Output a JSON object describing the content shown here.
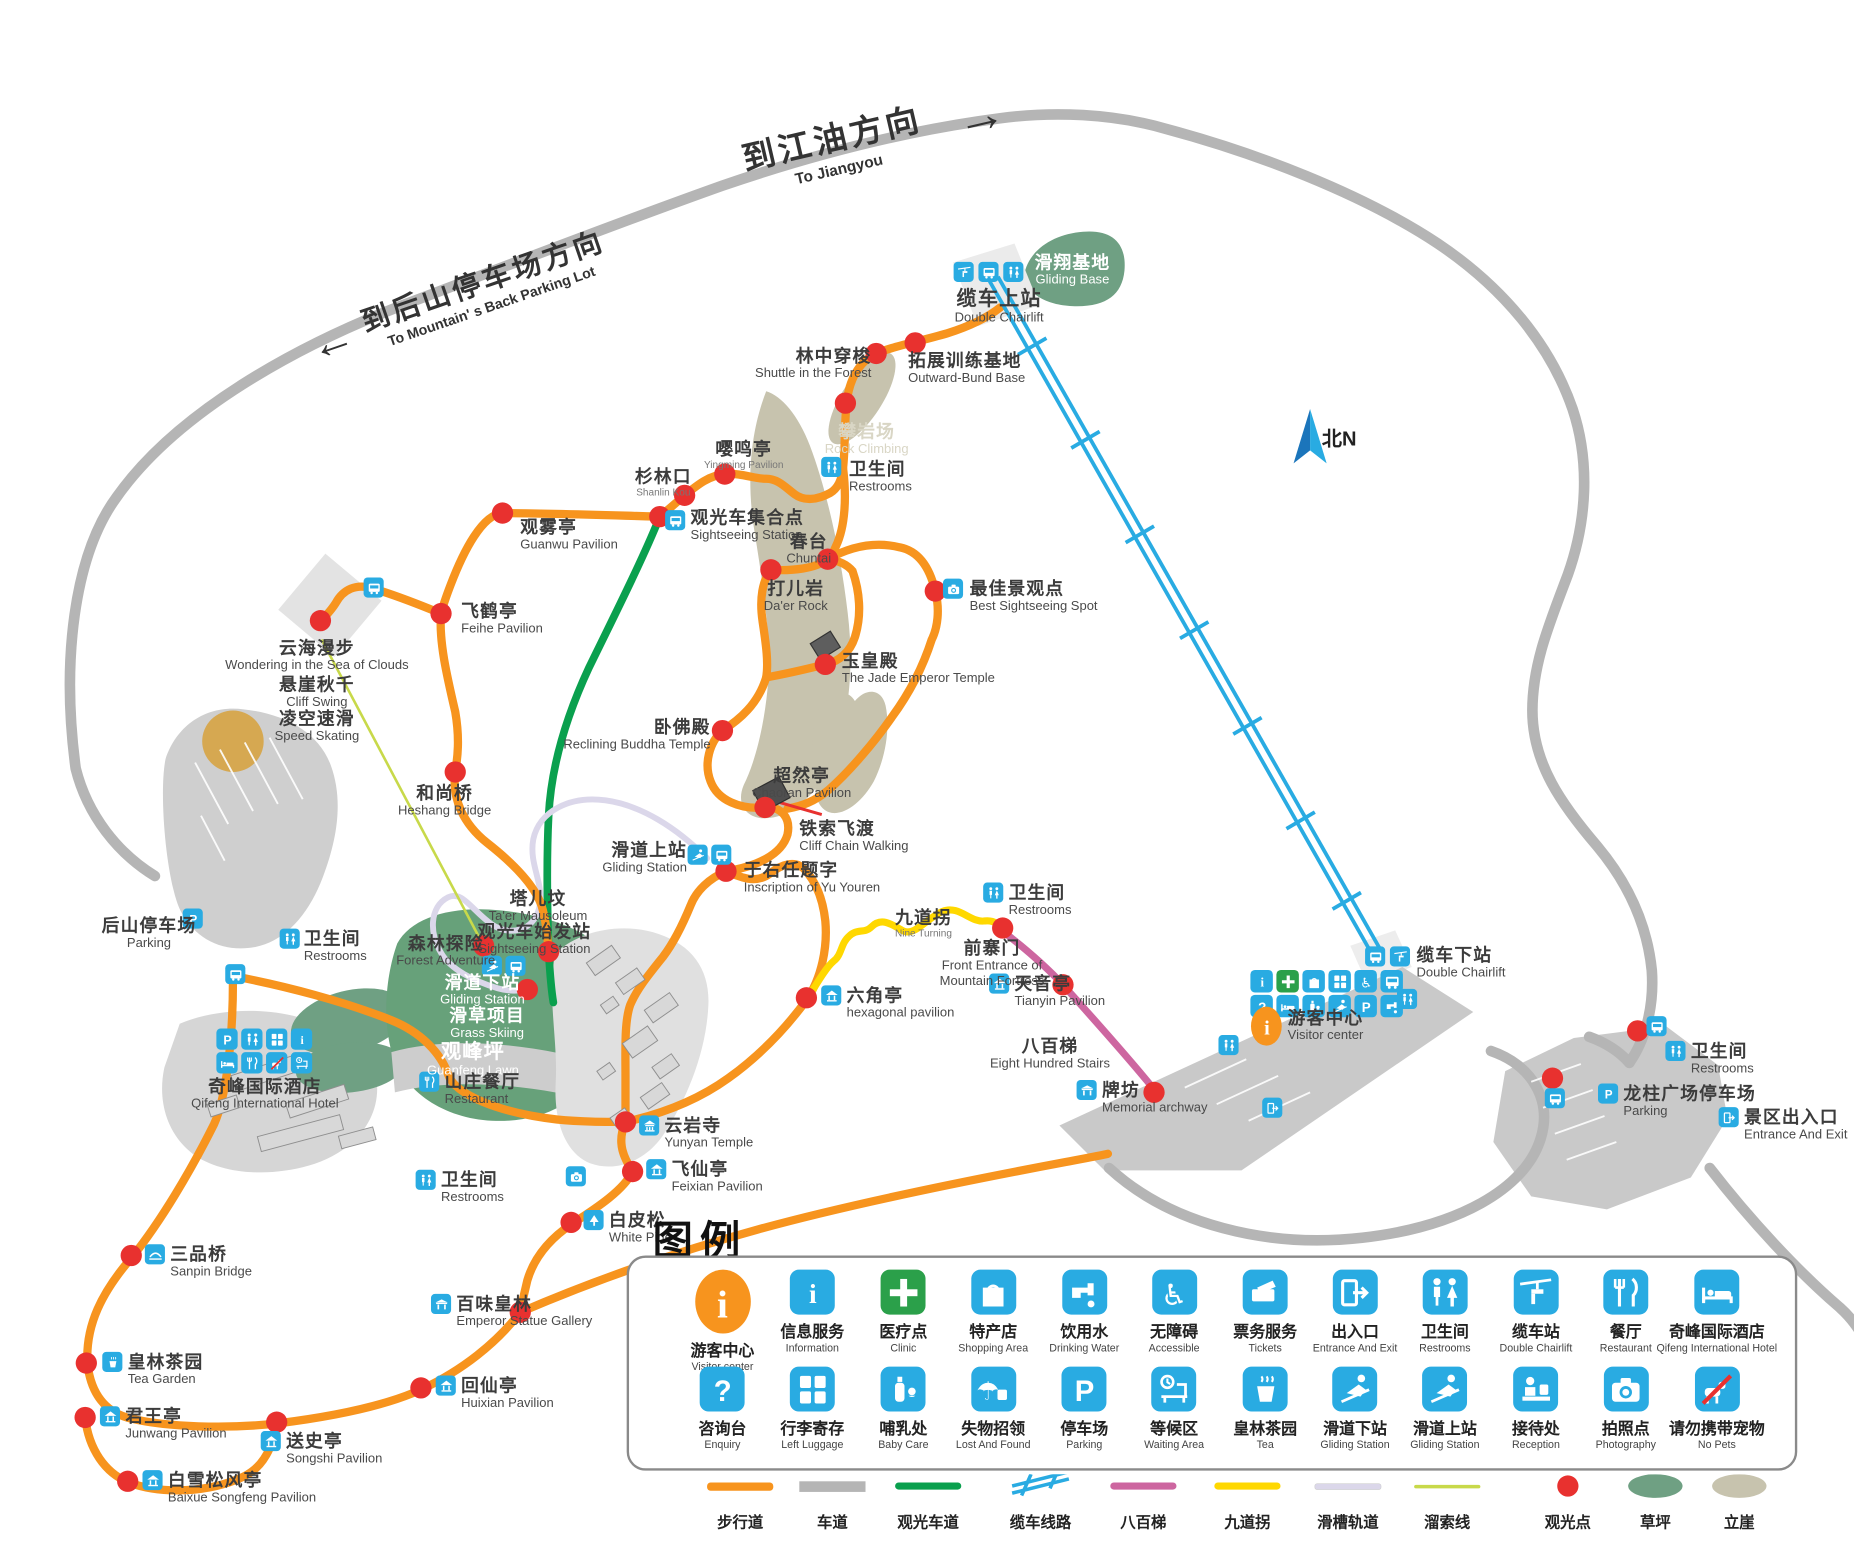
{
  "directions": {
    "jiangyou": {
      "cn": "到江油方向",
      "en": "To Jiangyou",
      "arrow": "→"
    },
    "back_parking": {
      "cn": "到后山停车场方向",
      "en": "To Mountain' s Back Parking Lot",
      "arrow": "←"
    }
  },
  "compass": {
    "label": "北N"
  },
  "colors": {
    "walking": "#F7941E",
    "road": "#B5B5B5",
    "sightseeing": "#0AA04E",
    "cable": "#29ABE2",
    "stairs": "#CD66A0",
    "nineturn": "#FFD800",
    "chute": "#DBD7EA",
    "zipline": "#C8D94A",
    "spot": "#E8312F",
    "lawn": "#6FA083",
    "cliff": "#C7C3AE",
    "chip": "#29ABE2",
    "visitor": "#F7941E",
    "clinic": "#2BA04A"
  },
  "pois": [
    {
      "id": "gliding-base",
      "cn": "滑翔基地",
      "en": "Gliding Base",
      "x": 907,
      "y": 214,
      "a": "c",
      "cls": "white"
    },
    {
      "id": "cable-top-station",
      "cn": "缆车上站",
      "en": "Double Chairlift",
      "x": 845,
      "y": 243,
      "a": "c",
      "cls": "bigcn"
    },
    {
      "id": "outward-bund-base",
      "cn": "拓展训练基地",
      "en": "Outward-Bund Base",
      "x": 768,
      "y": 297,
      "a": "l"
    },
    {
      "id": "shuttle-in-forest",
      "cn": "林中穿梭",
      "en": "Shuttle in the Forest",
      "x": 737,
      "y": 293,
      "a": "r"
    },
    {
      "id": "rock-climbing",
      "cn": "攀岩场",
      "en": "Rock Climbing",
      "x": 733,
      "y": 357,
      "a": "c",
      "cls": "pale"
    },
    {
      "id": "restrooms-north",
      "cn": "卫生间",
      "en": "Restrooms",
      "x": 718,
      "y": 389,
      "a": "l"
    },
    {
      "id": "yingming-pavilion",
      "cn": "嘤鸣亭",
      "en": "Yingming Pavilion",
      "x": 629,
      "y": 372,
      "a": "c",
      "cls": "smen"
    },
    {
      "id": "shanlinkou",
      "cn": "杉林口",
      "en": "Shanlin Kou",
      "x": 561,
      "y": 395,
      "a": "c",
      "cls": "smen"
    },
    {
      "id": "sightseeing-meet",
      "cn": "观光车集合点",
      "en": "Sightseeing Station",
      "x": 584,
      "y": 430,
      "a": "l"
    },
    {
      "id": "guanwu-pavilion",
      "cn": "观雾亭",
      "en": "Guanwu Pavilion",
      "x": 440,
      "y": 438,
      "a": "l"
    },
    {
      "id": "chuntai",
      "cn": "春台",
      "en": "Chuntai",
      "x": 684,
      "y": 450,
      "a": "c"
    },
    {
      "id": "daer-rock",
      "cn": "打儿岩",
      "en": "Da'er Rock",
      "x": 673,
      "y": 490,
      "a": "c"
    },
    {
      "id": "best-sightseeing",
      "cn": "最佳景观点",
      "en": "Best Sightseeing Spot",
      "x": 820,
      "y": 490,
      "a": "l"
    },
    {
      "id": "feihe-pavilion",
      "cn": "飞鹤亭",
      "en": "Feihe Pavilion",
      "x": 390,
      "y": 509,
      "a": "l"
    },
    {
      "id": "sea-of-clouds",
      "cn": "云海漫步",
      "en": "Wondering in the Sea of Clouds",
      "x": 268,
      "y": 540,
      "a": "c"
    },
    {
      "id": "cliff-swing",
      "cn": "悬崖秋千",
      "en": "Cliff Swing",
      "x": 268,
      "y": 571,
      "a": "c"
    },
    {
      "id": "speed-skating",
      "cn": "凌空速滑",
      "en": "Speed Skating",
      "x": 268,
      "y": 600,
      "a": "c"
    },
    {
      "id": "jade-emperor-temple",
      "cn": "玉皇殿",
      "en": "The Jade Emperor Temple",
      "x": 712,
      "y": 551,
      "a": "l"
    },
    {
      "id": "reclining-buddha-temple",
      "cn": "卧佛殿",
      "en": "Reclining Buddha Temple",
      "x": 601,
      "y": 607,
      "a": "r"
    },
    {
      "id": "chaoran-pavilion",
      "cn": "超然亭",
      "en": "Chaoran Pavilion",
      "x": 678,
      "y": 648,
      "a": "c"
    },
    {
      "id": "cliff-chain-walking",
      "cn": "铁索飞渡",
      "en": "Cliff Chain Walking",
      "x": 676,
      "y": 693,
      "a": "l"
    },
    {
      "id": "heshang-bridge",
      "cn": "和尚桥",
      "en": "Heshang Bridge",
      "x": 376,
      "y": 663,
      "a": "c"
    },
    {
      "id": "gliding-station-top",
      "cn": "滑道上站",
      "en": "Gliding Station",
      "x": 581,
      "y": 711,
      "a": "r"
    },
    {
      "id": "yu-youren-inscription",
      "cn": "于右任题字",
      "en": "Inscription of Yu Youren",
      "x": 629,
      "y": 728,
      "a": "l"
    },
    {
      "id": "taer-mausoleum",
      "cn": "塔儿坟",
      "en": "Ta'er Mausoleum",
      "x": 455,
      "y": 752,
      "a": "c"
    },
    {
      "id": "sightseeing-start",
      "cn": "观光车始发站",
      "en": "Sightseeing Station",
      "x": 452,
      "y": 780,
      "a": "c"
    },
    {
      "id": "forest-adventure",
      "cn": "森林探险",
      "en": "Forest Adventure",
      "x": 377,
      "y": 790,
      "a": "c"
    },
    {
      "id": "gliding-station-lower",
      "cn": "滑道下站",
      "en": "Gliding Station",
      "x": 408,
      "y": 823,
      "a": "c",
      "cls": "white"
    },
    {
      "id": "grass-skiing",
      "cn": "滑草项目",
      "en": "Grass Skiing",
      "x": 412,
      "y": 851,
      "a": "c",
      "cls": "white"
    },
    {
      "id": "guanfeng-lawn",
      "cn": "观峰坪",
      "en": "Guanfeng Lawn",
      "x": 400,
      "y": 880,
      "a": "c",
      "cls": "white bigcn"
    },
    {
      "id": "restaurant",
      "cn": "山庄餐厅",
      "en": "Restaurant",
      "x": 376,
      "y": 907,
      "a": "l"
    },
    {
      "id": "nine-turning",
      "cn": "九道拐",
      "en": "Nine Turning",
      "x": 781,
      "y": 768,
      "a": "c",
      "cls": "smen"
    },
    {
      "id": "restrooms-nineturn",
      "cn": "卫生间",
      "en": "Restrooms",
      "x": 853,
      "y": 747,
      "a": "l"
    },
    {
      "id": "front-entrance-fortress",
      "cn": "前寨门",
      "en": "Front Entrance of\nMountain Fortress",
      "x": 839,
      "y": 794,
      "a": "c"
    },
    {
      "id": "tianyin-pavilion",
      "cn": "天音亭",
      "en": "Tianyin Pavilion",
      "x": 858,
      "y": 824,
      "a": "l"
    },
    {
      "id": "eight-hundred-stairs",
      "cn": "八百梯",
      "en": "Eight Hundred Stairs",
      "x": 888,
      "y": 877,
      "a": "c"
    },
    {
      "id": "memorial-archway",
      "cn": "牌坊",
      "en": "Memorial archway",
      "x": 932,
      "y": 914,
      "a": "l"
    },
    {
      "id": "visitor-center",
      "cn": "游客中心",
      "en": "Visitor center",
      "x": 1089,
      "y": 853,
      "a": "l"
    },
    {
      "id": "cable-bottom-station",
      "cn": "缆车下站",
      "en": "Double Chairlift",
      "x": 1198,
      "y": 800,
      "a": "l"
    },
    {
      "id": "restrooms-east-lot",
      "cn": "卫生间",
      "en": "Restrooms",
      "x": 1430,
      "y": 881,
      "a": "l"
    },
    {
      "id": "longzhu-square-parking",
      "cn": "龙柱广场停车场",
      "en": "Parking",
      "x": 1373,
      "y": 917,
      "a": "l"
    },
    {
      "id": "scenic-entrance-exit",
      "cn": "景区出入口",
      "en": "Entrance And Exit",
      "x": 1475,
      "y": 937,
      "a": "l"
    },
    {
      "id": "back-mountain-parking",
      "cn": "后山停车场",
      "en": "Parking",
      "x": 126,
      "y": 775,
      "a": "c"
    },
    {
      "id": "restrooms-back-lot",
      "cn": "卫生间",
      "en": "Restrooms",
      "x": 257,
      "y": 786,
      "a": "l"
    },
    {
      "id": "qifeng-hotel",
      "cn": "奇峰国际酒店",
      "en": "Qifeng International Hotel",
      "x": 224,
      "y": 911,
      "a": "c"
    },
    {
      "id": "restrooms-temple",
      "cn": "卫生间",
      "en": "Restrooms",
      "x": 373,
      "y": 990,
      "a": "l"
    },
    {
      "id": "yunyan-temple",
      "cn": "云岩寺",
      "en": "Yunyan Temple",
      "x": 562,
      "y": 944,
      "a": "l"
    },
    {
      "id": "feixian-pavilion",
      "cn": "飞仙亭",
      "en": "Feixian Pavilion",
      "x": 568,
      "y": 981,
      "a": "l"
    },
    {
      "id": "white-pine",
      "cn": "白皮松",
      "en": "White Pine",
      "x": 515,
      "y": 1024,
      "a": "l"
    },
    {
      "id": "emperor-statue-gallery",
      "cn": "百味皇林",
      "en": "Emperor Statue Gallery",
      "x": 386,
      "y": 1095,
      "a": "l"
    },
    {
      "id": "sanpin-bridge",
      "cn": "三品桥",
      "en": "Sanpin Bridge",
      "x": 144,
      "y": 1053,
      "a": "l"
    },
    {
      "id": "tea-garden",
      "cn": "皇林茶园",
      "en": "Tea Garden",
      "x": 108,
      "y": 1144,
      "a": "l"
    },
    {
      "id": "junwang-pavilion",
      "cn": "君王亭",
      "en": "Junwang Pavilion",
      "x": 106,
      "y": 1190,
      "a": "l"
    },
    {
      "id": "songshi-pavilion",
      "cn": "送史亭",
      "en": "Songshi Pavilion",
      "x": 242,
      "y": 1211,
      "a": "l"
    },
    {
      "id": "huixian-pavilion",
      "cn": "回仙亭",
      "en": "Huixian Pavilion",
      "x": 390,
      "y": 1164,
      "a": "l"
    },
    {
      "id": "baixue-songfeng-pavilion",
      "cn": "白雪松风亭",
      "en": "Baixue Songfeng Pavilion",
      "x": 142,
      "y": 1244,
      "a": "l"
    },
    {
      "id": "hexagonal-pavilion",
      "cn": "六角亭",
      "en": "hexagonal pavilion",
      "x": 716,
      "y": 834,
      "a": "l"
    }
  ],
  "chips": [
    {
      "icon": "chairlift",
      "x": 815,
      "y": 230
    },
    {
      "icon": "bus",
      "x": 836,
      "y": 230
    },
    {
      "icon": "restrooms",
      "x": 857,
      "y": 230
    },
    {
      "icon": "restrooms",
      "x": 703,
      "y": 395
    },
    {
      "icon": "bus",
      "x": 571,
      "y": 440
    },
    {
      "icon": "bus",
      "x": 316,
      "y": 497
    },
    {
      "icon": "camera",
      "x": 806,
      "y": 498
    },
    {
      "icon": "gliding",
      "x": 590,
      "y": 723
    },
    {
      "icon": "bus",
      "x": 610,
      "y": 723
    },
    {
      "icon": "gliding",
      "x": 416,
      "y": 817
    },
    {
      "icon": "bus",
      "x": 436,
      "y": 817
    },
    {
      "icon": "restaurant",
      "x": 363,
      "y": 915
    },
    {
      "icon": "restrooms",
      "x": 360,
      "y": 998
    },
    {
      "icon": "temple",
      "x": 549,
      "y": 952
    },
    {
      "icon": "camera",
      "x": 487,
      "y": 995
    },
    {
      "icon": "pavilion",
      "x": 555,
      "y": 989
    },
    {
      "icon": "pine",
      "x": 502,
      "y": 1032
    },
    {
      "icon": "archway",
      "x": 373,
      "y": 1103
    },
    {
      "icon": "bridge",
      "x": 131,
      "y": 1061
    },
    {
      "icon": "tea",
      "x": 95,
      "y": 1152
    },
    {
      "icon": "pavilion",
      "x": 93,
      "y": 1198
    },
    {
      "icon": "pavilion",
      "x": 229,
      "y": 1219
    },
    {
      "icon": "pavilion",
      "x": 377,
      "y": 1172
    },
    {
      "icon": "pavilion",
      "x": 129,
      "y": 1252
    },
    {
      "icon": "pavilion",
      "x": 703,
      "y": 842
    },
    {
      "icon": "restrooms",
      "x": 840,
      "y": 755
    },
    {
      "icon": "pavilion",
      "x": 845,
      "y": 832
    },
    {
      "icon": "archway",
      "x": 919,
      "y": 922
    },
    {
      "icon": "bus",
      "x": 1163,
      "y": 809
    },
    {
      "icon": "chairlift",
      "x": 1184,
      "y": 809
    },
    {
      "icon": "restrooms",
      "x": 1190,
      "y": 845
    },
    {
      "icon": "restrooms",
      "x": 1039,
      "y": 884
    },
    {
      "icon": "exit",
      "x": 1076,
      "y": 937
    },
    {
      "icon": "restrooms",
      "x": 1417,
      "y": 889
    },
    {
      "icon": "parking",
      "x": 1360,
      "y": 925
    },
    {
      "icon": "exit",
      "x": 1462,
      "y": 945
    },
    {
      "icon": "parking",
      "x": 163,
      "y": 777
    },
    {
      "icon": "restrooms",
      "x": 245,
      "y": 794
    },
    {
      "icon": "bus",
      "x": 199,
      "y": 824
    },
    {
      "icon": "bus",
      "x": 1401,
      "y": 868
    },
    {
      "icon": "bus",
      "x": 1315,
      "y": 929
    },
    {
      "icon": "information",
      "x": 1067,
      "y": 830,
      "s": 19
    },
    {
      "icon": "clinic",
      "x": 1089,
      "y": 830,
      "s": 19
    },
    {
      "icon": "shopping",
      "x": 1111,
      "y": 830,
      "s": 19
    },
    {
      "icon": "luggage",
      "x": 1133,
      "y": 830,
      "s": 19
    },
    {
      "icon": "accessible",
      "x": 1155,
      "y": 830,
      "s": 19
    },
    {
      "icon": "bus",
      "x": 1177,
      "y": 830,
      "s": 19
    },
    {
      "icon": "question",
      "x": 1067,
      "y": 851,
      "s": 19
    },
    {
      "icon": "hotel",
      "x": 1089,
      "y": 851,
      "s": 19
    },
    {
      "icon": "baby",
      "x": 1111,
      "y": 851,
      "s": 19
    },
    {
      "icon": "gliding",
      "x": 1133,
      "y": 851,
      "s": 19
    },
    {
      "icon": "parking",
      "x": 1155,
      "y": 851,
      "s": 19
    },
    {
      "icon": "water",
      "x": 1177,
      "y": 851,
      "s": 19
    },
    {
      "icon": "visitor",
      "x": 1071,
      "y": 868
    },
    {
      "icon": "parking",
      "x": 192,
      "y": 879,
      "s": 18
    },
    {
      "icon": "restrooms",
      "x": 213,
      "y": 879,
      "s": 18
    },
    {
      "icon": "luggage",
      "x": 234,
      "y": 879,
      "s": 18
    },
    {
      "icon": "information",
      "x": 255,
      "y": 879,
      "s": 18
    },
    {
      "icon": "hotel",
      "x": 192,
      "y": 899,
      "s": 18
    },
    {
      "icon": "restaurant",
      "x": 213,
      "y": 899,
      "s": 18
    },
    {
      "icon": "nopets",
      "x": 234,
      "y": 899,
      "s": 18
    },
    {
      "icon": "waiting",
      "x": 255,
      "y": 899,
      "s": 18
    }
  ],
  "dots": [
    {
      "x": 741,
      "y": 299
    },
    {
      "x": 774,
      "y": 290
    },
    {
      "x": 715,
      "y": 341
    },
    {
      "x": 613,
      "y": 401
    },
    {
      "x": 579,
      "y": 419
    },
    {
      "x": 558,
      "y": 437
    },
    {
      "x": 425,
      "y": 434
    },
    {
      "x": 373,
      "y": 519
    },
    {
      "x": 271,
      "y": 525
    },
    {
      "x": 700,
      "y": 473
    },
    {
      "x": 652,
      "y": 482
    },
    {
      "x": 791,
      "y": 500
    },
    {
      "x": 698,
      "y": 562
    },
    {
      "x": 611,
      "y": 618
    },
    {
      "x": 647,
      "y": 683
    },
    {
      "x": 614,
      "y": 737
    },
    {
      "x": 385,
      "y": 653
    },
    {
      "x": 464,
      "y": 805
    },
    {
      "x": 409,
      "y": 800
    },
    {
      "x": 446,
      "y": 837
    },
    {
      "x": 529,
      "y": 949
    },
    {
      "x": 535,
      "y": 991
    },
    {
      "x": 483,
      "y": 1034
    },
    {
      "x": 440,
      "y": 1110
    },
    {
      "x": 111,
      "y": 1062
    },
    {
      "x": 73,
      "y": 1153
    },
    {
      "x": 72,
      "y": 1199
    },
    {
      "x": 234,
      "y": 1203
    },
    {
      "x": 356,
      "y": 1174
    },
    {
      "x": 108,
      "y": 1253
    },
    {
      "x": 682,
      "y": 844
    },
    {
      "x": 848,
      "y": 785
    },
    {
      "x": 899,
      "y": 833
    },
    {
      "x": 976,
      "y": 924
    },
    {
      "x": 1385,
      "y": 872
    },
    {
      "x": 1313,
      "y": 912
    }
  ],
  "legend": {
    "title": "图例",
    "row1": [
      {
        "icon": "visitor",
        "cn": "游客中心",
        "en": "Visitor center"
      },
      {
        "icon": "information",
        "cn": "信息服务",
        "en": "Information"
      },
      {
        "icon": "clinic",
        "cn": "医疗点",
        "en": "Clinic"
      },
      {
        "icon": "shopping",
        "cn": "特产店",
        "en": "Shopping Area"
      },
      {
        "icon": "water",
        "cn": "饮用水",
        "en": "Drinking Water"
      },
      {
        "icon": "accessible",
        "cn": "无障碍",
        "en": "Accessible"
      },
      {
        "icon": "tickets",
        "cn": "票务服务",
        "en": "Tickets"
      },
      {
        "icon": "exit",
        "cn": "出入口",
        "en": "Entrance And Exit"
      },
      {
        "icon": "restrooms",
        "cn": "卫生间",
        "en": "Restrooms"
      },
      {
        "icon": "chairlift",
        "cn": "缆车站",
        "en": "Double Chairlift"
      },
      {
        "icon": "restaurant",
        "cn": "餐厅",
        "en": "Restaurant"
      },
      {
        "icon": "hotel",
        "cn": "奇峰国际酒店",
        "en": "Qifeng International Hotel"
      }
    ],
    "row2": [
      {
        "icon": "question",
        "cn": "咨询台",
        "en": "Enquiry"
      },
      {
        "icon": "luggage",
        "cn": "行李寄存",
        "en": "Left Luggage"
      },
      {
        "icon": "baby",
        "cn": "哺乳处",
        "en": "Baby Care"
      },
      {
        "icon": "lost",
        "cn": "失物招领",
        "en": "Lost And Found"
      },
      {
        "icon": "parking",
        "cn": "停车场",
        "en": "Parking"
      },
      {
        "icon": "waiting",
        "cn": "等候区",
        "en": "Waiting Area"
      },
      {
        "icon": "tea",
        "cn": "皇林茶园",
        "en": "Tea"
      },
      {
        "icon": "gliding",
        "cn": "滑道下站",
        "en": "Gliding Station"
      },
      {
        "icon": "gliding",
        "cn": "滑道上站",
        "en": "Gliding Station"
      },
      {
        "icon": "reception",
        "cn": "接待处",
        "en": "Reception"
      },
      {
        "icon": "camera",
        "cn": "拍照点",
        "en": "Photography"
      },
      {
        "icon": "nopets",
        "cn": "请勿携带宠物",
        "en": "No Pets"
      }
    ],
    "lines": [
      {
        "type": "walking",
        "label": "步行道"
      },
      {
        "type": "road",
        "label": "车道"
      },
      {
        "type": "sightseeing",
        "label": "观光车道"
      },
      {
        "type": "cable",
        "label": "缆车线路"
      },
      {
        "type": "stairs",
        "label": "八百梯"
      },
      {
        "type": "nineturn",
        "label": "九道拐"
      },
      {
        "type": "chute",
        "label": "滑槽轨道"
      },
      {
        "type": "zipline",
        "label": "溜索线"
      },
      {
        "type": "spot",
        "label": "观光点"
      },
      {
        "type": "lawn",
        "label": "草坪"
      },
      {
        "type": "cliff",
        "label": "立崖"
      }
    ]
  }
}
